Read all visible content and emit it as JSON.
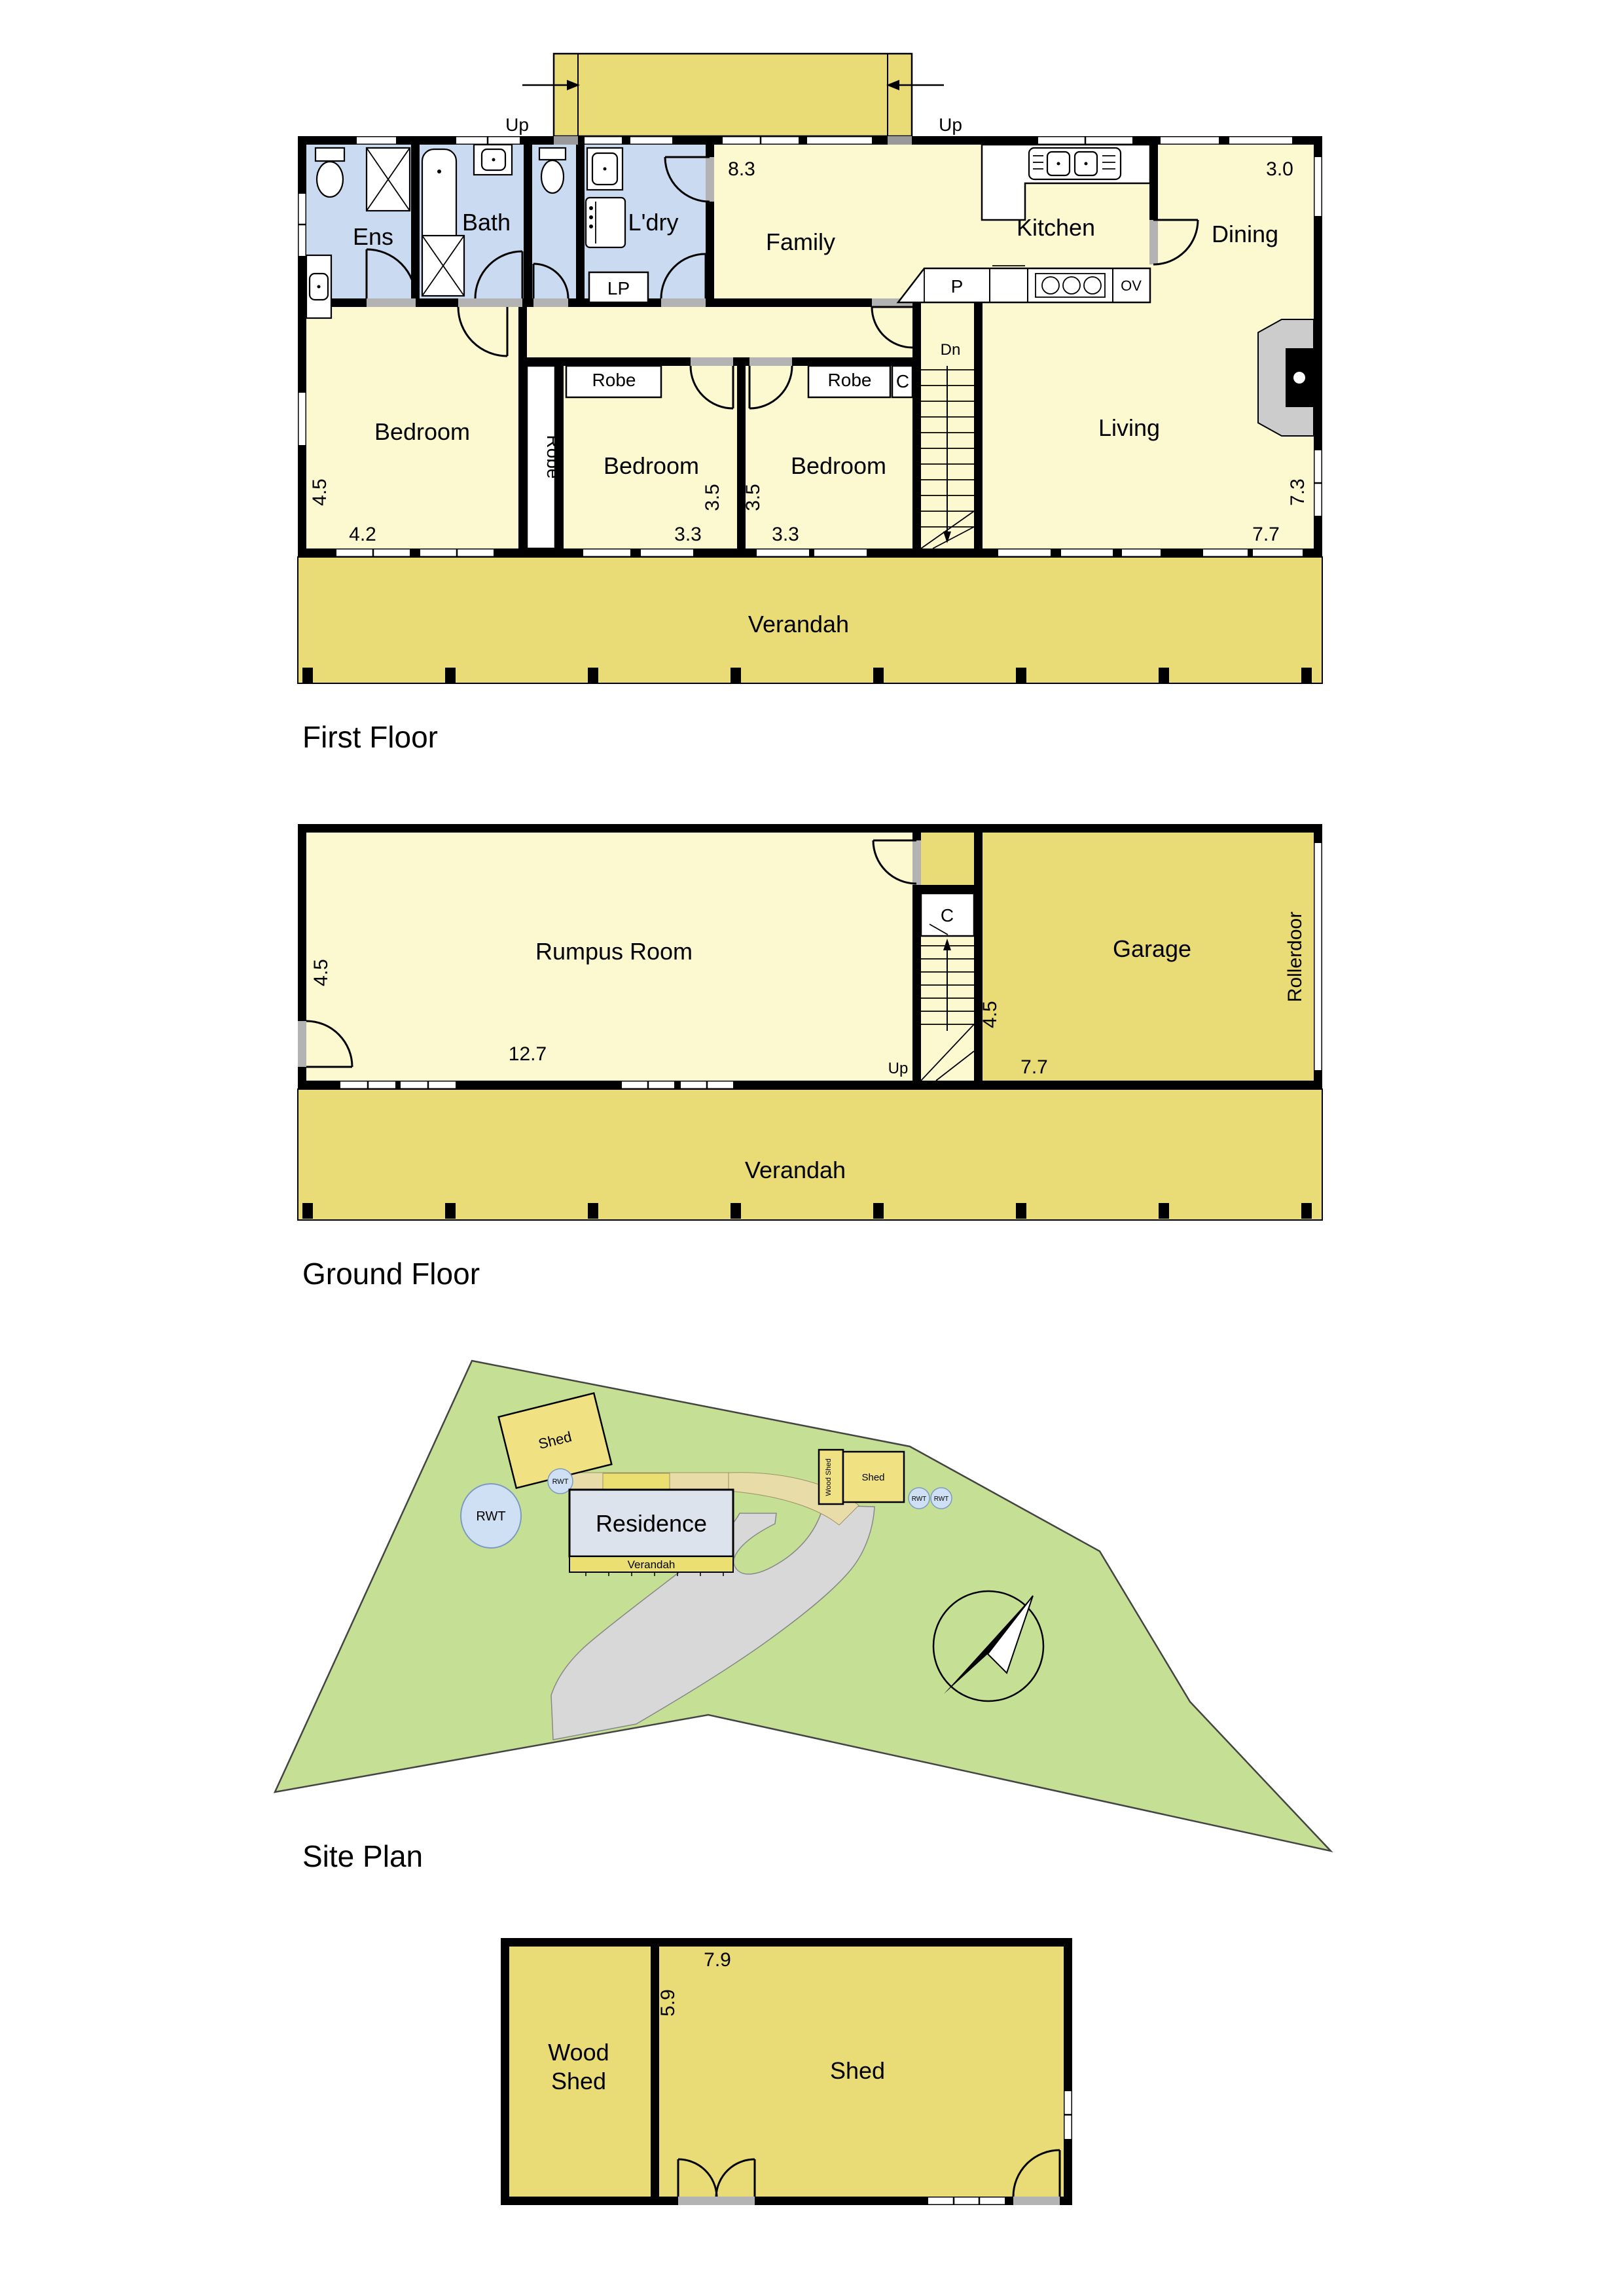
{
  "colors": {
    "floor_pale_yellow": "#FCF8D0",
    "deck_dark_yellow": "#E9DB76",
    "wet_room_blue": "#C9DAF1",
    "site_green": "#C5DF95",
    "driveway_grey": "#D8D8D8",
    "residence_grey_blue": "#DCE3ED",
    "rwt_blue": "#CFE0F4",
    "wall_black": "#000000"
  },
  "first_floor": {
    "section_label": "First Floor",
    "up_left": "Up",
    "up_right": "Up",
    "ens": "Ens",
    "bath": "Bath",
    "laundry": "L'dry",
    "lp": "LP",
    "family": "Family",
    "kitchen": "Kitchen",
    "dining": "Dining",
    "living": "Living",
    "pantry": "P",
    "oven": "OV",
    "down": "Dn",
    "bedroom1": "Bedroom",
    "bedroom2": "Bedroom",
    "bedroom3": "Bedroom",
    "robe_tall": "Robe",
    "robe2": "Robe",
    "robe3": "Robe",
    "closet": "C",
    "verandah": "Verandah",
    "dims": {
      "family_width": "8.3",
      "dining_width": "3.0",
      "bed1_depth": "4.5",
      "bed1_width": "4.2",
      "bed2_depth": "3.5",
      "bed2_width": "3.3",
      "bed3_depth": "3.5",
      "bed3_width": "3.3",
      "living_depth": "7.3",
      "living_width": "7.7"
    }
  },
  "ground_floor": {
    "section_label": "Ground Floor",
    "rumpus": "Rumpus Room",
    "garage": "Garage",
    "closet": "C",
    "up": "Up",
    "rollerdoor": "Rollerdoor",
    "verandah": "Verandah",
    "dims": {
      "rumpus_depth": "4.5",
      "rumpus_width": "12.7",
      "stair_depth": "4.5",
      "garage_width": "7.7"
    }
  },
  "site_plan": {
    "section_label": "Site Plan",
    "residence": "Residence",
    "verandah": "Verandah",
    "shed_nw": "Shed",
    "rwt_large": "RWT",
    "rwt_near_house": "RWT",
    "wood_shed": "Wood Shed",
    "shed_east": "Shed",
    "rwt_east_1": "RWT",
    "rwt_east_2": "RWT"
  },
  "shed_plan": {
    "wood_shed_line1": "Wood",
    "wood_shed_line2": "Shed",
    "shed": "Shed",
    "dims": {
      "width": "7.9",
      "depth": "5.9"
    }
  }
}
